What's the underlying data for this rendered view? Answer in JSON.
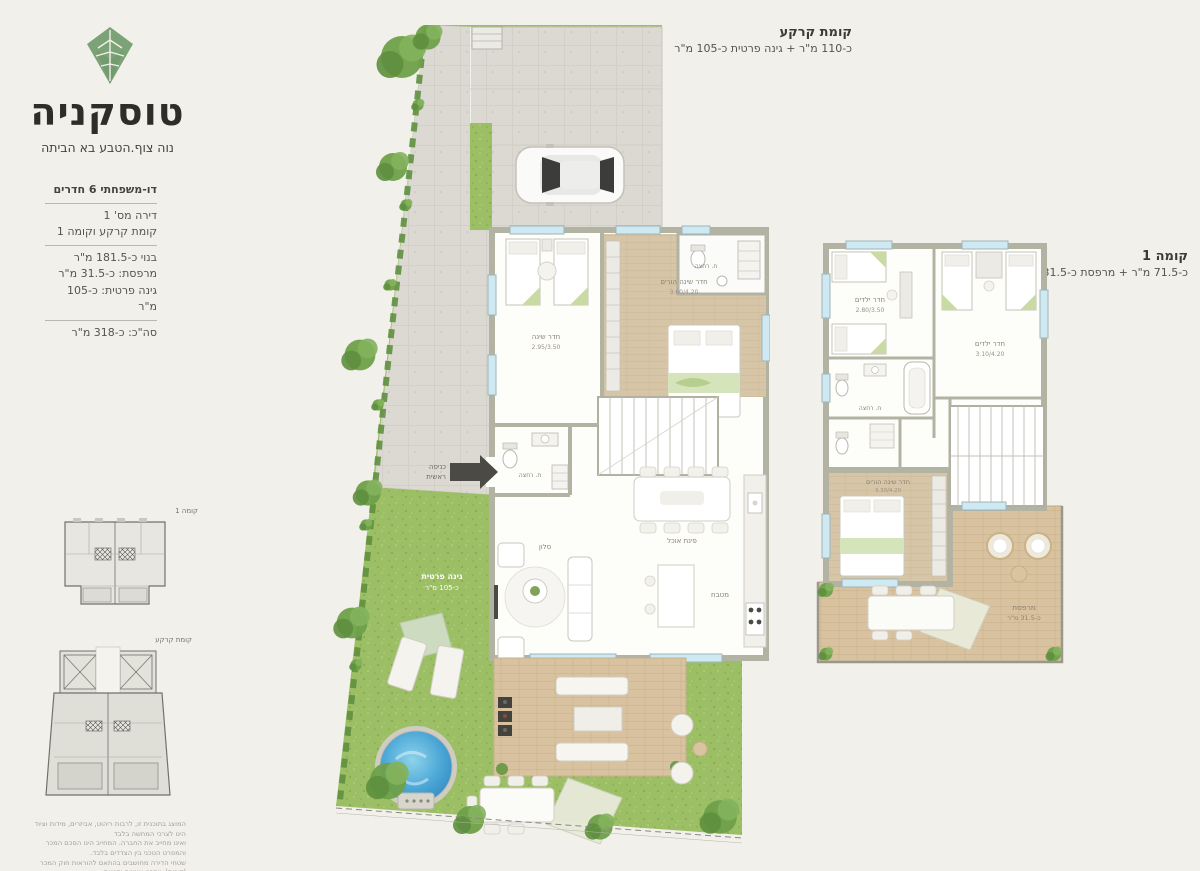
{
  "brand": {
    "title": "טוסקניה",
    "subtitle": "נוה צוף.הטבע בא הביתה",
    "logo": "leaf-diamond-icon"
  },
  "specs": {
    "type": "דו-משפחתי 6 חדרים",
    "unit": "דירה מס' 1",
    "floors": "קומת קרקע וקומה 1",
    "built": "בנוי כ-181.5 מ\"ר",
    "balcony": "מרפסת: כ-31.5 מ\"ר",
    "garden": "גינה פרטית: כ-105 מ\"ר",
    "total": "סה\"כ: כ-318 מ\"ר"
  },
  "ground_floor": {
    "title": "קומת קרקע",
    "subtitle": "כ-110 מ\"ר + גינה פרטית כ-105 מ\"ר",
    "rooms": {
      "bedroom": {
        "name": "חדר שינה",
        "dims": "2.95/3.50"
      },
      "master": {
        "name": "חדר שינה הורים",
        "dims": "3.60/4.20"
      },
      "bath_top": {
        "name": "ח. רחצה"
      },
      "bath_mid": {
        "name": "ח. רחצה"
      },
      "dining": {
        "name": "פינת אוכל"
      },
      "kitchen": {
        "name": "מטבח"
      },
      "living": {
        "name": "סלון"
      },
      "entrance_l1": "כניסה",
      "entrance_l2": "ראשית",
      "garden_l1": "גינה פרטית",
      "garden_l2": "כ-105 מ\"ר"
    }
  },
  "first_floor": {
    "title": "קומה 1",
    "subtitle": "כ-71.5 מ\"ר + מרפסת כ-31.5 מ\"ר",
    "rooms": {
      "kids_a": {
        "name": "חדר ילדים",
        "dims": "2.80/3.50"
      },
      "kids_b": {
        "name": "חדר ילדים",
        "dims": "3.10/4.20"
      },
      "bath": {
        "name": "ח. רחצה"
      },
      "master": {
        "name": "חדר שינה הורים",
        "dims": "3.30/4.20"
      },
      "terrace_l1": "מרפסת",
      "terrace_l2": "כ-31.5 מ\"ר"
    }
  },
  "keyplans": {
    "floor1_label": "קומה 1",
    "ground_label": "קומת קרקע"
  },
  "disclaimer": {
    "lines": [
      "המוצג בתוכנית זו, לרבות ריהוט, אביזרים, מידות וציוד הינו לצרכי המחשה בלבד",
      "ואינו מחייב את החברה. המחייב הינו הסכם המכר והמפרט הטכני בין הצדדים בלבד.",
      "שטחי הדירה מחושבים בהתאם להוראות חוק המכר (דירות). ייתכנו שינויים וסטיות",
      "בין המוצג לבין הביצוע בפועל. התוכנית אינה בקנה מידה. ט.ל.ח.",
      "02.2023"
    ]
  },
  "colors": {
    "background": "#f2f0ea",
    "brand_green": "#7ca378",
    "grass": "#9cbf66",
    "pool_blue": "#3e9ed2",
    "deck_wood": "#d8c29f",
    "wall_gray": "#b3b3a4",
    "text_dark": "#2f2d29"
  }
}
